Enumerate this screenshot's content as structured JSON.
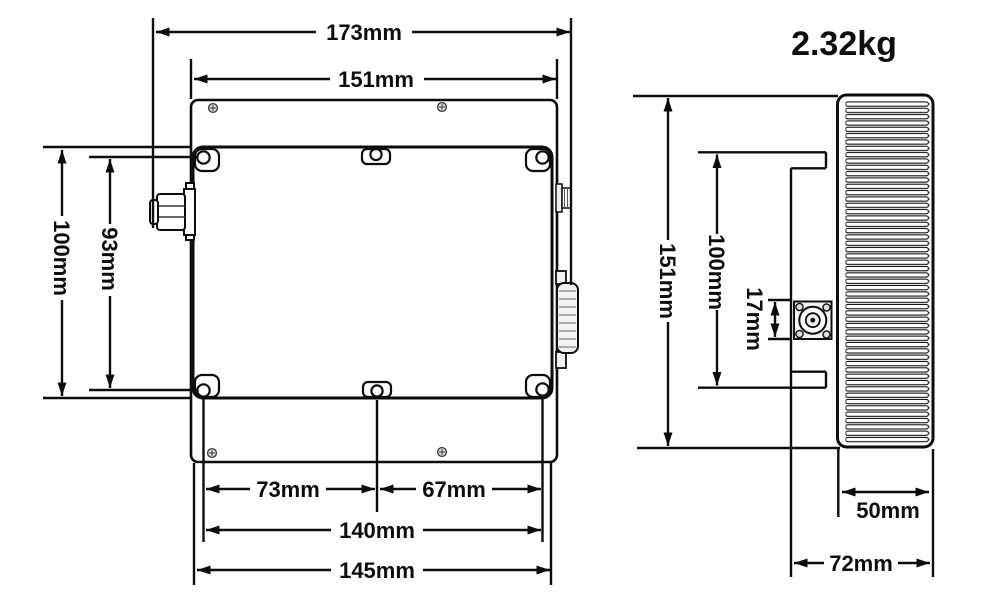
{
  "weight_label": "2.32kg",
  "top_view": {
    "dim_overall_width": "173mm",
    "dim_plate_width": "151mm",
    "dim_body_height": "100mm",
    "dim_hole_span_vertical": "93mm",
    "dim_hole_offset_left": "73mm",
    "dim_hole_offset_right": "67mm",
    "dim_hole_span_horizontal": "140mm",
    "dim_body_width": "145mm"
  },
  "side_view": {
    "dim_overall_height": "151mm",
    "dim_body_height": "100mm",
    "dim_connector_offset": "17mm",
    "dim_heatsink_depth": "50mm",
    "dim_overall_depth": "72mm"
  },
  "colors": {
    "line": "#0d0d0d",
    "background": "#ffffff"
  }
}
